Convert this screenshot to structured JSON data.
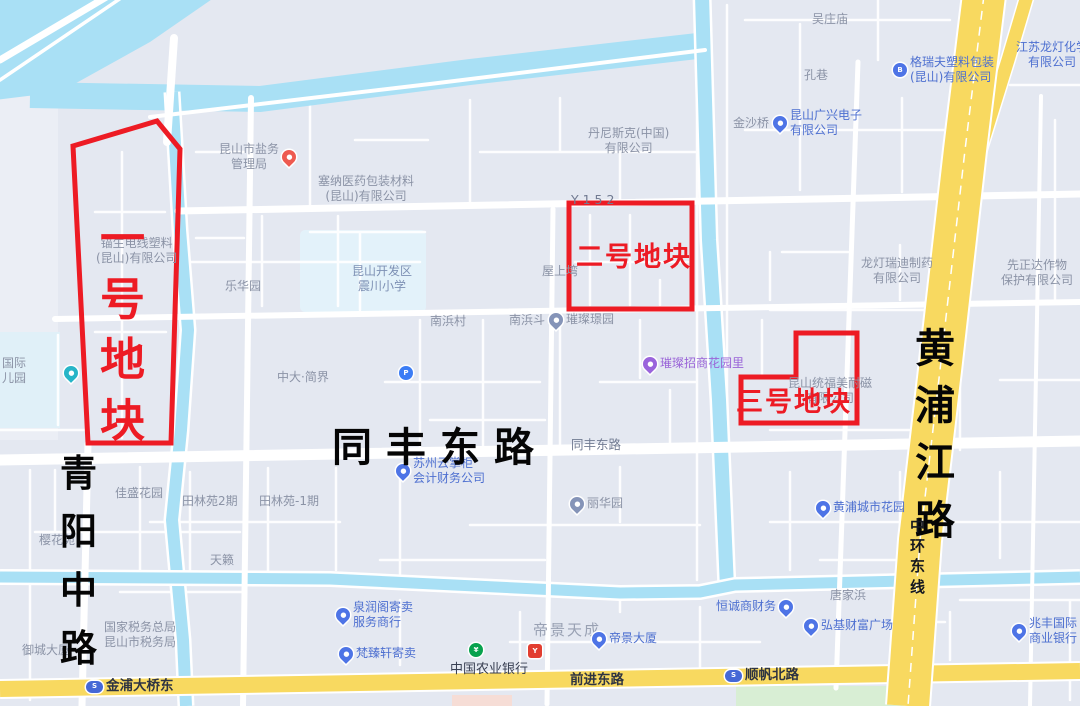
{
  "map": {
    "colors": {
      "land": "#e4e8f1",
      "water": "#a9e0f5",
      "road_white": "#ffffff",
      "highway_yellow": "#f8d960",
      "parcel_red": "#ed1b24",
      "poi_gray": "#8b93a6",
      "poi_blue": "#4d6fd0",
      "poi_purple": "#9a64d8",
      "park_green": "#d8eed4"
    },
    "parcels": [
      {
        "name": "parcel-1",
        "label": "一号地块"
      },
      {
        "name": "parcel-2",
        "label": "二号地块"
      },
      {
        "name": "parcel-3",
        "label": "三号地块"
      }
    ],
    "icons": {
      "pin-blue": {
        "shape": "pin",
        "color": "#4e74e6",
        "glyph": "●"
      },
      "pin-red": {
        "shape": "pin",
        "color": "#ee5a50",
        "glyph": "●"
      },
      "pin-purple": {
        "shape": "pin",
        "color": "#9a64dc",
        "glyph": "●"
      },
      "pin-teal": {
        "shape": "pin",
        "color": "#27b5c8",
        "glyph": "●"
      },
      "pin-gray": {
        "shape": "pin",
        "color": "#8594b8",
        "glyph": "●"
      },
      "circle-blue": {
        "shape": "circle",
        "color": "#4e74e6",
        "glyph": "B"
      },
      "circle-p": {
        "shape": "circle",
        "color": "#3b7cf5",
        "glyph": "P"
      },
      "circle-green": {
        "shape": "circle",
        "color": "#08a24e",
        "glyph": "¥"
      },
      "square-red": {
        "shape": "square",
        "color": "#e23d30",
        "glyph": "Y"
      },
      "metro": {
        "shape": "oval",
        "color": "#4568d6",
        "glyph": "S"
      }
    },
    "labels": [
      {
        "name": "poi-wuzhuangmiao",
        "x": 812,
        "y": 12,
        "cls": "poi",
        "text": "吴庄庙",
        "it": true
      },
      {
        "name": "poi-kongxiang",
        "x": 804,
        "y": 68,
        "cls": "poi",
        "text": "孔巷",
        "it": true
      },
      {
        "name": "poi-jinshaqiao",
        "x": 733,
        "y": 116,
        "cls": "poi",
        "text": "金沙桥",
        "it": true
      },
      {
        "name": "poi-kunshan-guangxing",
        "x": 773,
        "y": 108,
        "cls": "poi blue row",
        "icon": "pin-blue",
        "text": "昆山广兴电子\n有限公司",
        "it": true
      },
      {
        "name": "poi-geruifu",
        "x": 893,
        "y": 55,
        "cls": "poi blue row",
        "icon": "circle-blue",
        "text": "格瑞夫塑料包装\n(昆山)有限公司",
        "it": true
      },
      {
        "name": "poi-jiangsu-longdeng",
        "x": 1016,
        "y": 40,
        "cls": "poi blue ta-c",
        "text": "江苏龙灯化学\n有限公司",
        "it": true
      },
      {
        "name": "poi-dannisike",
        "x": 588,
        "y": 126,
        "cls": "poi ta-c",
        "text": "丹尼斯克(中国)\n有限公司",
        "it": true
      },
      {
        "name": "poi-saina-yiyao",
        "x": 318,
        "y": 174,
        "cls": "poi ta-c",
        "text": "塞纳医药包装材料\n(昆山)有限公司",
        "it": true
      },
      {
        "name": "poi-yanwu-guanliju",
        "x": 219,
        "y": 142,
        "cls": "poi ta-c row",
        "icon": "pin-red",
        "iconAfter": true,
        "text": "昆山市盐务\n管理局",
        "it": true
      },
      {
        "name": "poi-maosheng-dianxian",
        "x": 96,
        "y": 236,
        "cls": "poi ta-c",
        "text": "锚生电线塑料\n(昆山)有限公司",
        "it": true
      },
      {
        "name": "poi-lehuayuan",
        "x": 225,
        "y": 279,
        "cls": "poi",
        "text": "乐华园",
        "it": true
      },
      {
        "name": "poi-zhenchuan-xiaoxue",
        "x": 352,
        "y": 264,
        "cls": "school ta-c",
        "text": "昆山开发区\n震川小学",
        "it": true
      },
      {
        "name": "roadlabel-y152",
        "x": 571,
        "y": 192,
        "cls": "roadname-sm",
        "text": "Y 1 5 2",
        "it": false
      },
      {
        "name": "poi-wushangwan",
        "x": 542,
        "y": 264,
        "cls": "poi",
        "text": "屋上塆",
        "it": true
      },
      {
        "name": "poi-nanbangcun",
        "x": 430,
        "y": 314,
        "cls": "poi",
        "text": "南浜村",
        "it": true
      },
      {
        "name": "poi-nanbangdou",
        "x": 509,
        "y": 313,
        "cls": "poi",
        "text": "南浜斗",
        "it": true
      },
      {
        "name": "poi-cuican-jingyuan",
        "x": 549,
        "y": 312,
        "cls": "poi row",
        "icon": "pin-gray",
        "text": "璀璨璟园",
        "it": true
      },
      {
        "name": "poi-zhongda-jianjie",
        "x": 277,
        "y": 370,
        "cls": "poi",
        "text": "中大·简界",
        "it": true
      },
      {
        "name": "poi-parking",
        "x": 399,
        "y": 366,
        "cls": "row",
        "icon": "circle-p",
        "text": "",
        "it": true
      },
      {
        "name": "poi-cuican-zhaoshang",
        "x": 643,
        "y": 356,
        "cls": "poi purple row",
        "icon": "pin-purple",
        "text": "璀璨招商花园里",
        "it": true
      },
      {
        "name": "poi-longdeng-ruidi",
        "x": 861,
        "y": 256,
        "cls": "poi ta-c",
        "text": "龙灯瑞迪制药\n有限公司",
        "it": true
      },
      {
        "name": "poi-xianzhengda",
        "x": 1001,
        "y": 258,
        "cls": "poi ta-c",
        "text": "先正达作物\n保护有限公司",
        "it": true
      },
      {
        "name": "poi-tongfu-meinaici",
        "x": 788,
        "y": 376,
        "cls": "poi ta-c",
        "text": "昆山统福美耐磁\n有限公司",
        "it": true
      },
      {
        "name": "poi-guoji-eryuan",
        "x": 2,
        "y": 356,
        "cls": "poi",
        "text": "国际\n儿园",
        "it": true
      },
      {
        "name": "poi-eryuan-pin",
        "x": 64,
        "y": 366,
        "cls": "row",
        "icon": "pin-teal",
        "text": "",
        "it": true
      },
      {
        "name": "poi-yinghuayuan",
        "x": 39,
        "y": 533,
        "cls": "poi",
        "text": "樱花苑",
        "it": true
      },
      {
        "name": "poi-jiasheng-huayuan",
        "x": 115,
        "y": 486,
        "cls": "poi",
        "text": "佳盛花园",
        "it": true
      },
      {
        "name": "poi-tianlinyuan-2",
        "x": 182,
        "y": 494,
        "cls": "poi",
        "text": "田林苑2期",
        "it": true
      },
      {
        "name": "poi-tianlinyuan-1",
        "x": 259,
        "y": 494,
        "cls": "poi",
        "text": "田林苑-1期",
        "it": true
      },
      {
        "name": "poi-tianlai",
        "x": 210,
        "y": 553,
        "cls": "poi",
        "text": "天籁",
        "it": true
      },
      {
        "name": "poi-yucheng-dasha",
        "x": 22,
        "y": 643,
        "cls": "poi",
        "text": "御城大厦",
        "it": true
      },
      {
        "name": "poi-guojia-shuiwu",
        "x": 104,
        "y": 620,
        "cls": "poi ta-c",
        "text": "国家税务总局\n昆山市税务局",
        "it": true
      },
      {
        "name": "poi-suzhou-kuaiji",
        "x": 396,
        "y": 456,
        "cls": "poi blue row",
        "icon": "pin-blue",
        "text": "苏州云掌柜\n会计财务公司",
        "it": true
      },
      {
        "name": "roadlabel-tongfeng-small",
        "x": 571,
        "y": 437,
        "cls": "roadname-sm",
        "text": "同丰东路",
        "it": false
      },
      {
        "name": "poi-lihuayuan",
        "x": 570,
        "y": 496,
        "cls": "poi row",
        "icon": "pin-gray",
        "text": "丽华园",
        "it": true
      },
      {
        "name": "poi-huangpu-chengshi",
        "x": 816,
        "y": 500,
        "cls": "poi blue row",
        "icon": "pin-blue",
        "text": "黄浦城市花园",
        "it": true
      },
      {
        "name": "poi-tangjiabang",
        "x": 830,
        "y": 588,
        "cls": "poi",
        "text": "唐家浜",
        "it": true
      },
      {
        "name": "poi-hengcheng-caiwu",
        "x": 716,
        "y": 599,
        "cls": "poi blue row",
        "icon": "pin-blue",
        "iconAfter": true,
        "text": "恒诚商财务",
        "it": true
      },
      {
        "name": "poi-hongji-guangchang",
        "x": 804,
        "y": 618,
        "cls": "poi blue row",
        "icon": "pin-blue",
        "text": "弘基财富广场",
        "it": true
      },
      {
        "name": "poi-zhaofeng-guoji",
        "x": 1012,
        "y": 616,
        "cls": "poi blue row",
        "icon": "pin-blue",
        "text": "兆丰国际\n商业银行",
        "it": true
      },
      {
        "name": "poi-quanrun-jimai",
        "x": 336,
        "y": 600,
        "cls": "poi blue row",
        "icon": "pin-blue",
        "text": "泉润阁寄卖\n服务商行",
        "it": true
      },
      {
        "name": "poi-fanzhen-jimai",
        "x": 339,
        "y": 646,
        "cls": "poi blue row",
        "icon": "pin-blue",
        "text": "梵臻轩寄卖",
        "it": true
      },
      {
        "name": "poi-abc-bank-pin",
        "x": 469,
        "y": 643,
        "cls": "row",
        "icon": "circle-green",
        "text": "",
        "it": true
      },
      {
        "name": "poi-abc-bank",
        "x": 450,
        "y": 662,
        "cls": "bank",
        "text": "中国农业银行",
        "it": true
      },
      {
        "name": "poi-food-pin",
        "x": 528,
        "y": 644,
        "cls": "row",
        "icon": "square-red",
        "text": "",
        "it": true
      },
      {
        "name": "poi-dijing-tiancheng",
        "x": 533,
        "y": 621,
        "cls": "area-lg",
        "text": "帝景天成",
        "it": true
      },
      {
        "name": "poi-dijing-dasha",
        "x": 592,
        "y": 631,
        "cls": "poi blue row",
        "icon": "pin-blue",
        "text": "帝景大厦",
        "it": true
      },
      {
        "name": "roadlabel-qianjin",
        "x": 570,
        "y": 672,
        "cls": "road-dark",
        "text": "前进东路",
        "it": false
      },
      {
        "name": "station-jinpu-daqiao",
        "x": 86,
        "y": 678,
        "cls": "road-dark row",
        "icon": "metro",
        "text": "金浦大桥东",
        "it": true
      },
      {
        "name": "station-shunfan-beilu",
        "x": 725,
        "y": 667,
        "cls": "road-dark row",
        "icon": "metro",
        "text": "顺帆北路",
        "it": true
      },
      {
        "name": "roadname-tongfeng-donglu",
        "x": 332,
        "y": 423,
        "cls": "road-big",
        "text": "同丰东路",
        "it": false
      },
      {
        "name": "roadname-qingyang-zhonglu",
        "x": 60,
        "y": 450,
        "cls": "qy",
        "vertical": true,
        "gap": 11,
        "text": "青阳中路",
        "it": false
      },
      {
        "name": "roadname-huangpu-jianglu",
        "x": 915,
        "y": 324,
        "cls": "hp",
        "vertical": true,
        "gap": 6,
        "text": "黄浦江路",
        "it": false
      },
      {
        "name": "roadname-zhonghuan-dongxian",
        "x": 910,
        "y": 517,
        "cls": "zh",
        "vertical": true,
        "gap": 1,
        "text": "中环东线",
        "it": false
      },
      {
        "name": "parcel-1-label",
        "x": 100,
        "y": 210,
        "cls": "p1v",
        "vertical": true,
        "gap": 3,
        "text": "一号地块",
        "it": false
      },
      {
        "name": "parcel-2-label",
        "x": 576,
        "y": 241,
        "cls": "parcel",
        "text": "二号地块",
        "it": false
      },
      {
        "name": "parcel-3-label",
        "x": 736,
        "y": 386,
        "cls": "parcel",
        "text": "三号地块",
        "it": false
      }
    ]
  }
}
